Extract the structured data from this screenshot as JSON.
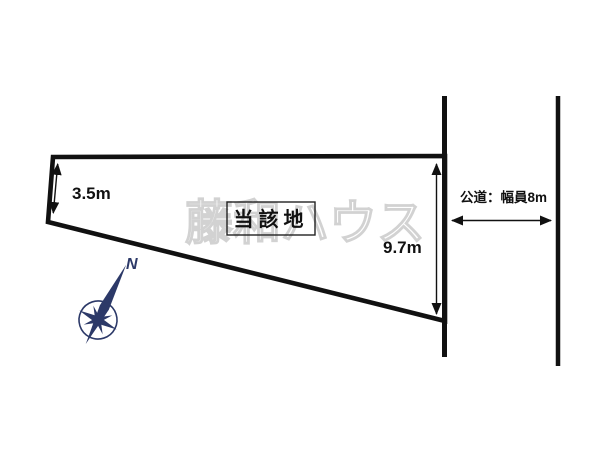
{
  "diagram": {
    "type": "land-plot-site-plan",
    "site_label": "当該地",
    "left_dimension": "3.5m",
    "right_dimension": "9.7m",
    "road_label": "公道：幅員8m",
    "north_label": "N",
    "watermark": "藤和ハウス"
  },
  "colors": {
    "background": "#ffffff",
    "line": "#111111",
    "text": "#111111",
    "box_border": "#222222",
    "compass": "#2c3968",
    "watermark": "#d2d2d2"
  }
}
